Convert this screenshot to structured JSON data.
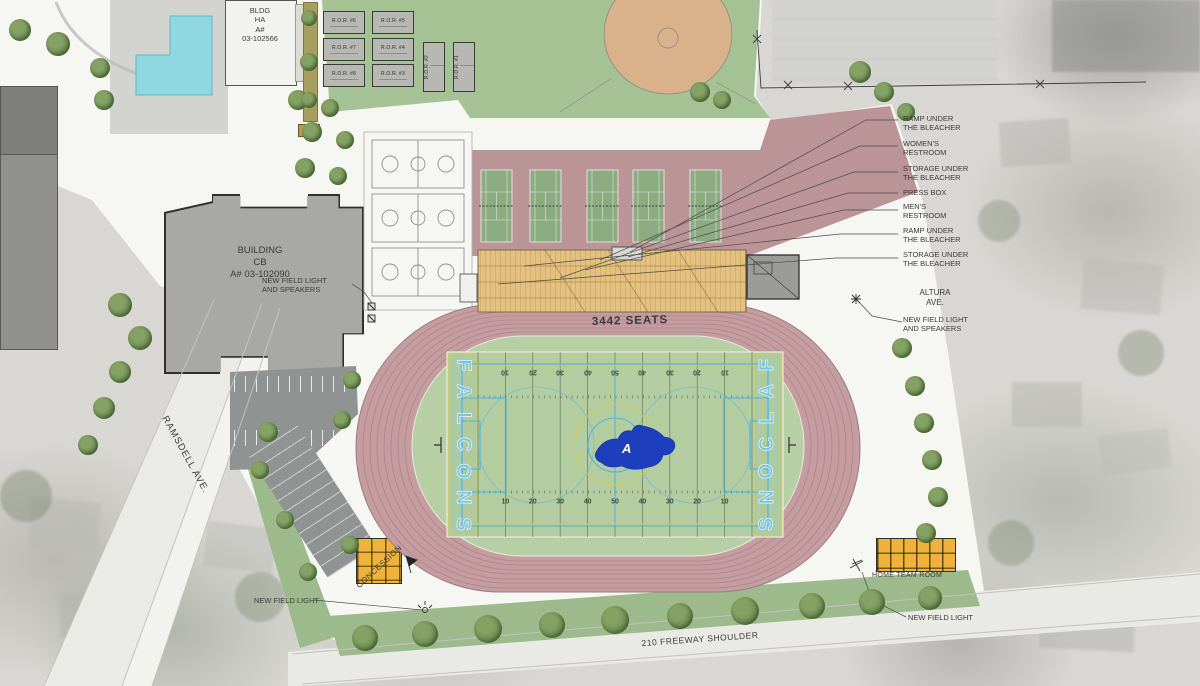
{
  "plan": {
    "buildings": {
      "bldg_ha": "BLDG\nHA\nA#\n03-102566",
      "building_cb": "BUILDING\nCB\nA# 03-102090",
      "concession": "CONCESSION",
      "home_team_room": "HOME TEAM ROOM"
    },
    "stadium": {
      "seats": "3442 SEATS",
      "team_name": "FALCONS",
      "logo_letter": "A",
      "yard_numbers": [
        "10",
        "20",
        "30",
        "40",
        "50",
        "40",
        "30",
        "20",
        "10"
      ]
    },
    "streets": {
      "ramsdell": "RAMSDELL AVE.",
      "altura": "ALTURA\nAVE.",
      "freeway": "210 FREEWAY SHOULDER"
    },
    "site_notes": {
      "new_field_light": "NEW FIELD LIGHT",
      "new_field_light_speakers": "NEW FIELD LIGHT\nAND SPEAKERS"
    },
    "callouts": [
      "RAMP UNDER\nTHE BLEACHER",
      "WOMEN'S\nRESTROOM",
      "STORAGE UNDER\nTHE BLEACHER",
      "PRESS BOX",
      "MEN'S\nRESTROOM",
      "RAMP UNDER\nTHE BLEACHER",
      "STORAGE UNDER\nTHE BLEACHER"
    ],
    "ror_units": [
      "R.O.R. #6",
      "R.O.R. #5",
      "R.O.R. #7",
      "R.O.R. #4",
      "R.O.R. #8",
      "R.O.R. #3",
      "R.O.R. #2",
      "R.O.R. #1"
    ],
    "colors": {
      "track": "#c59da1",
      "field_green": "#b6cfa4",
      "bleacher_tan": "#e5c17f",
      "tennis_deck": "#bb9498",
      "tennis_court": "#8bab80",
      "pool": "#8fd8e2",
      "team_blue": "#74c4ea",
      "logo_blue": "#1d3fbe",
      "accent_yellow": "#efb33c",
      "lawn": "#a5c295"
    }
  }
}
